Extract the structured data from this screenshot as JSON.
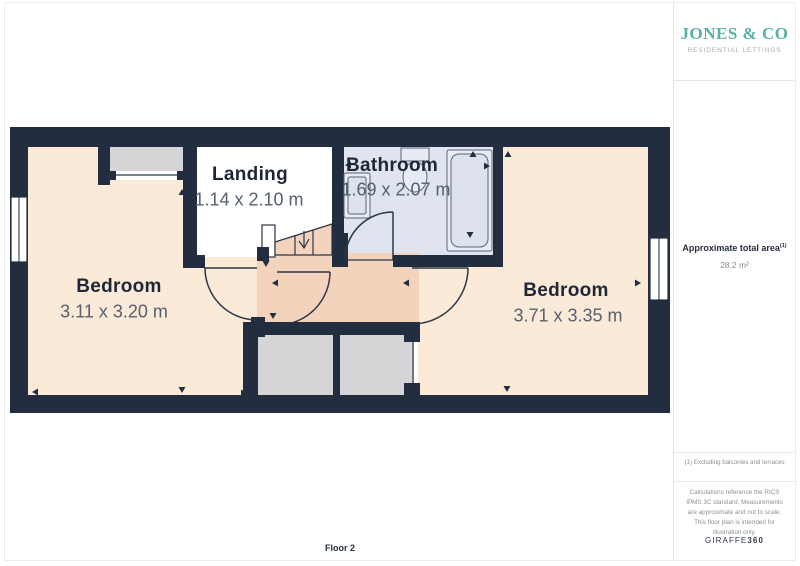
{
  "branding": {
    "name": "JONES & CO",
    "tagline": "RESIDENTIAL LETTINGS"
  },
  "plan": {
    "floor_label": "Floor 2",
    "rooms": [
      {
        "name": "Bedroom",
        "dims": "3.11 x 3.20 m"
      },
      {
        "name": "Landing",
        "dims": "1.14 x 2.10 m"
      },
      {
        "name": "Bathroom",
        "dims": "1.69 x 2.07 m"
      },
      {
        "name": "Bedroom",
        "dims": "3.71 x 3.35 m"
      }
    ],
    "colors": {
      "wall": "#222e40",
      "bedroom": "#fcead9",
      "hallway": "#f4d3bd",
      "bathroom": "#e0e4ee",
      "closet": "#d5d5d7",
      "landing": "#ffffff",
      "accent": "#56b0a5"
    }
  },
  "sidebar": {
    "area_title": "Approximate total area",
    "area_note_ref": "(1)",
    "area_value": "28.2 m²",
    "footnote": "(1) Excluding balconies and terraces",
    "disclaimer": "Calculations reference the RICS IPMS 3C standard. Measurements are approximate and not to scale. This floor plan is intended for illustration only.",
    "watermark": {
      "brand": "GIRAFFE",
      "suffix": "360"
    }
  }
}
